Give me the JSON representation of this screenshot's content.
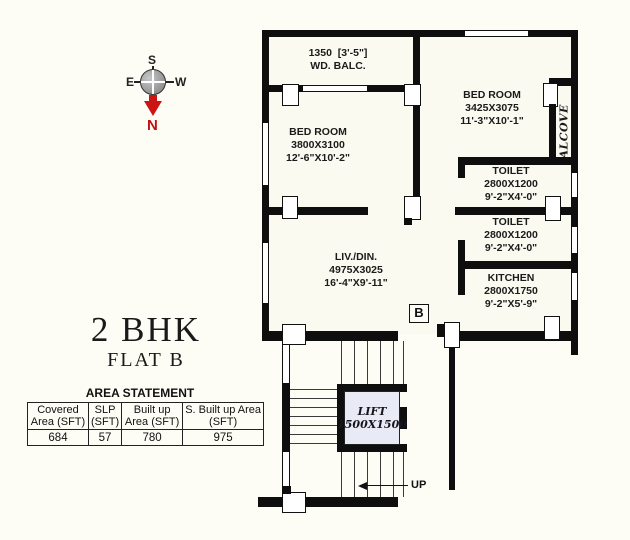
{
  "compass": {
    "north": "N",
    "south": "S",
    "east": "E",
    "west": "W"
  },
  "title": {
    "main": "2 BHK",
    "sub": "FLAT B"
  },
  "area_statement": {
    "title": "AREA STATEMENT",
    "columns": [
      "Covered Area (SFT)",
      "SLP (SFT)",
      "Built up Area (SFT)",
      "S. Built up Area (SFT)"
    ],
    "values": [
      "684",
      "57",
      "780",
      "975"
    ]
  },
  "rooms": {
    "balcony": {
      "l1": "1350  [3'-5\"]",
      "l2": "WD. BALC."
    },
    "bedroom1": {
      "l1": "BED ROOM",
      "l2": "3800X3100",
      "l3": "12'-6\"X10'-2\""
    },
    "bedroom2": {
      "l1": "BED ROOM",
      "l2": "3425X3075",
      "l3": "11'-3\"X10'-1\""
    },
    "alcove": {
      "l1": "ALCOVE"
    },
    "toilet1": {
      "l1": "TOILET",
      "l2": "2800X1200",
      "l3": "9'-2\"X4'-0\""
    },
    "toilet2": {
      "l1": "TOILET",
      "l2": "2800X1200",
      "l3": "9'-2\"X4'-0\""
    },
    "kitchen": {
      "l1": "KITCHEN",
      "l2": "2800X1750",
      "l3": "9'-2\"X5'-9\""
    },
    "living": {
      "l1": "LIV./DIN.",
      "l2": "4975X3025",
      "l3": "16'-4\"X9'-11\""
    },
    "lift": {
      "l1": "LIFT",
      "l2": "1500X1500"
    }
  },
  "markers": {
    "flat": "B",
    "up": "UP"
  },
  "colors": {
    "wall": "#0e0e0e",
    "north_red": "#cc1414",
    "lift_fill": "#e8eaf5"
  }
}
